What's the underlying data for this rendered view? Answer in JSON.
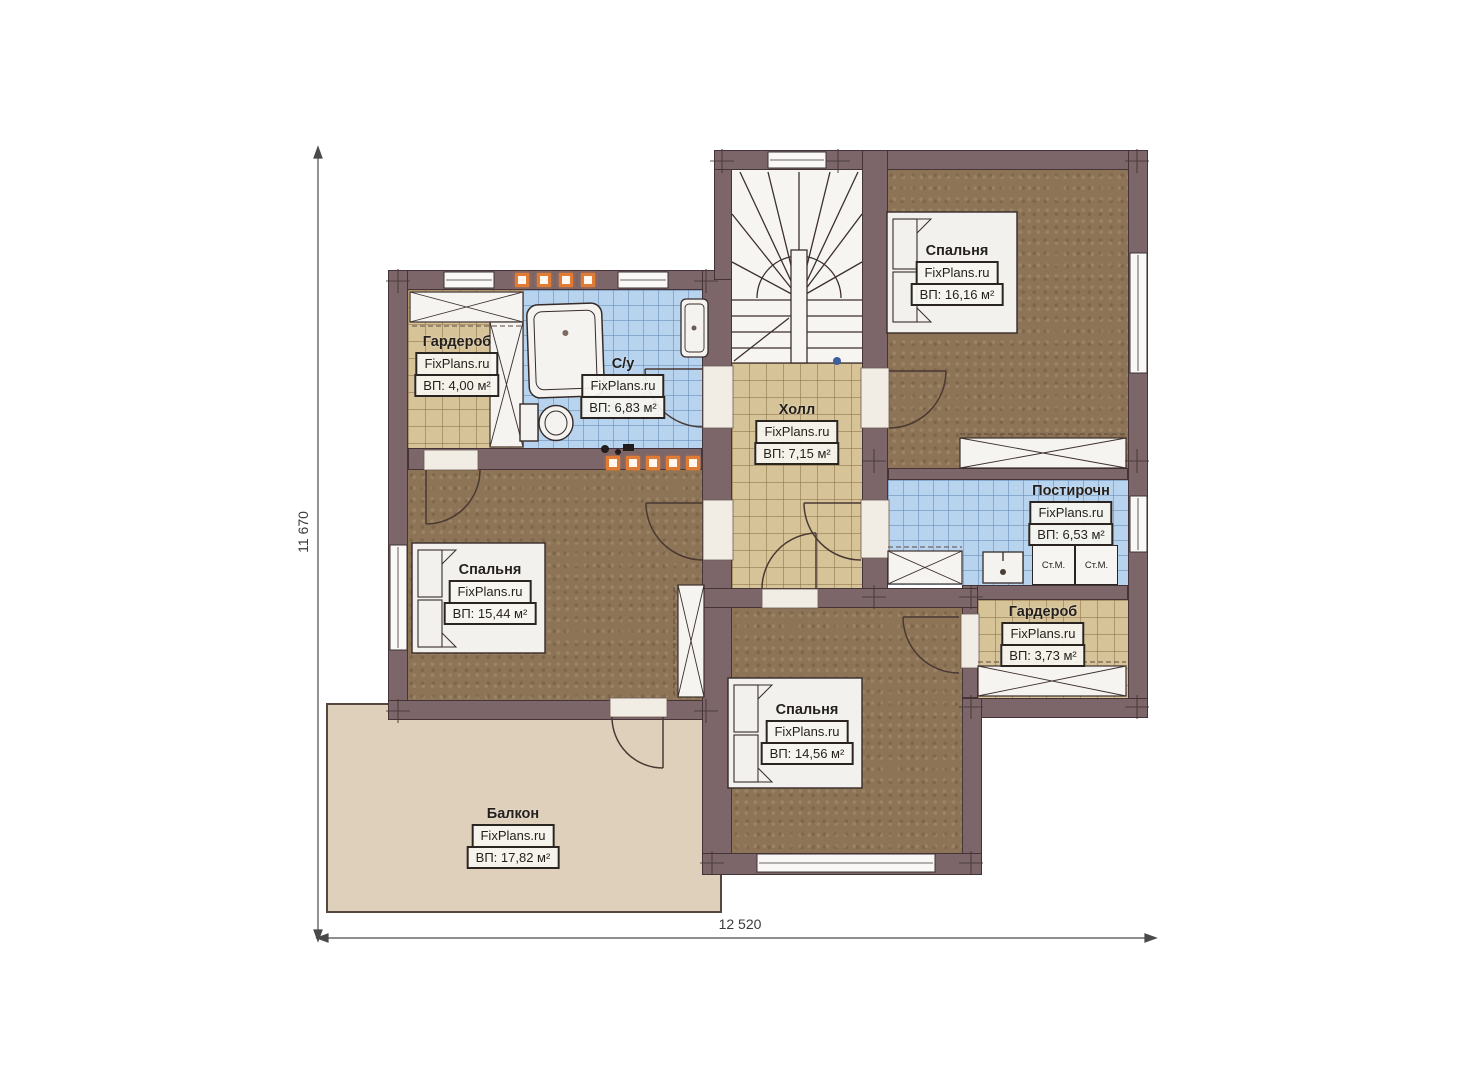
{
  "branding": "FixPlans.ru",
  "dimensions": {
    "horizontal": "12 520",
    "vertical": "11 670"
  },
  "appliance_labels": {
    "washing_machine": "Ст.М."
  },
  "rooms": [
    {
      "id": "wardrobe-top-left",
      "name": "Гардероб",
      "area": "ВП: 4,00 м²"
    },
    {
      "id": "bathroom",
      "name": "С/у",
      "area": "ВП: 6,83 м²"
    },
    {
      "id": "hall",
      "name": "Холл",
      "area": "ВП: 7,15 м²"
    },
    {
      "id": "bedroom-top-right",
      "name": "Спальня",
      "area": "ВП: 16,16 м²"
    },
    {
      "id": "laundry",
      "name": "Постирочн",
      "area": "ВП: 6,53 м²"
    },
    {
      "id": "bedroom-left",
      "name": "Спальня",
      "area": "ВП: 15,44 м²"
    },
    {
      "id": "wardrobe-right",
      "name": "Гардероб",
      "area": "ВП: 3,73 м²"
    },
    {
      "id": "bedroom-bottom",
      "name": "Спальня",
      "area": "ВП: 14,56 м²"
    },
    {
      "id": "balcony",
      "name": "Балкон",
      "area": "ВП: 17,82 м²"
    }
  ],
  "palette": {
    "wall": "#7c6669",
    "floor_wood": "#8d7456",
    "tile_tan": "#d6c398",
    "tile_blue": "#b7d3ee",
    "balcony_floor": "#ded0bb",
    "accent_orange": "#e07b35"
  }
}
